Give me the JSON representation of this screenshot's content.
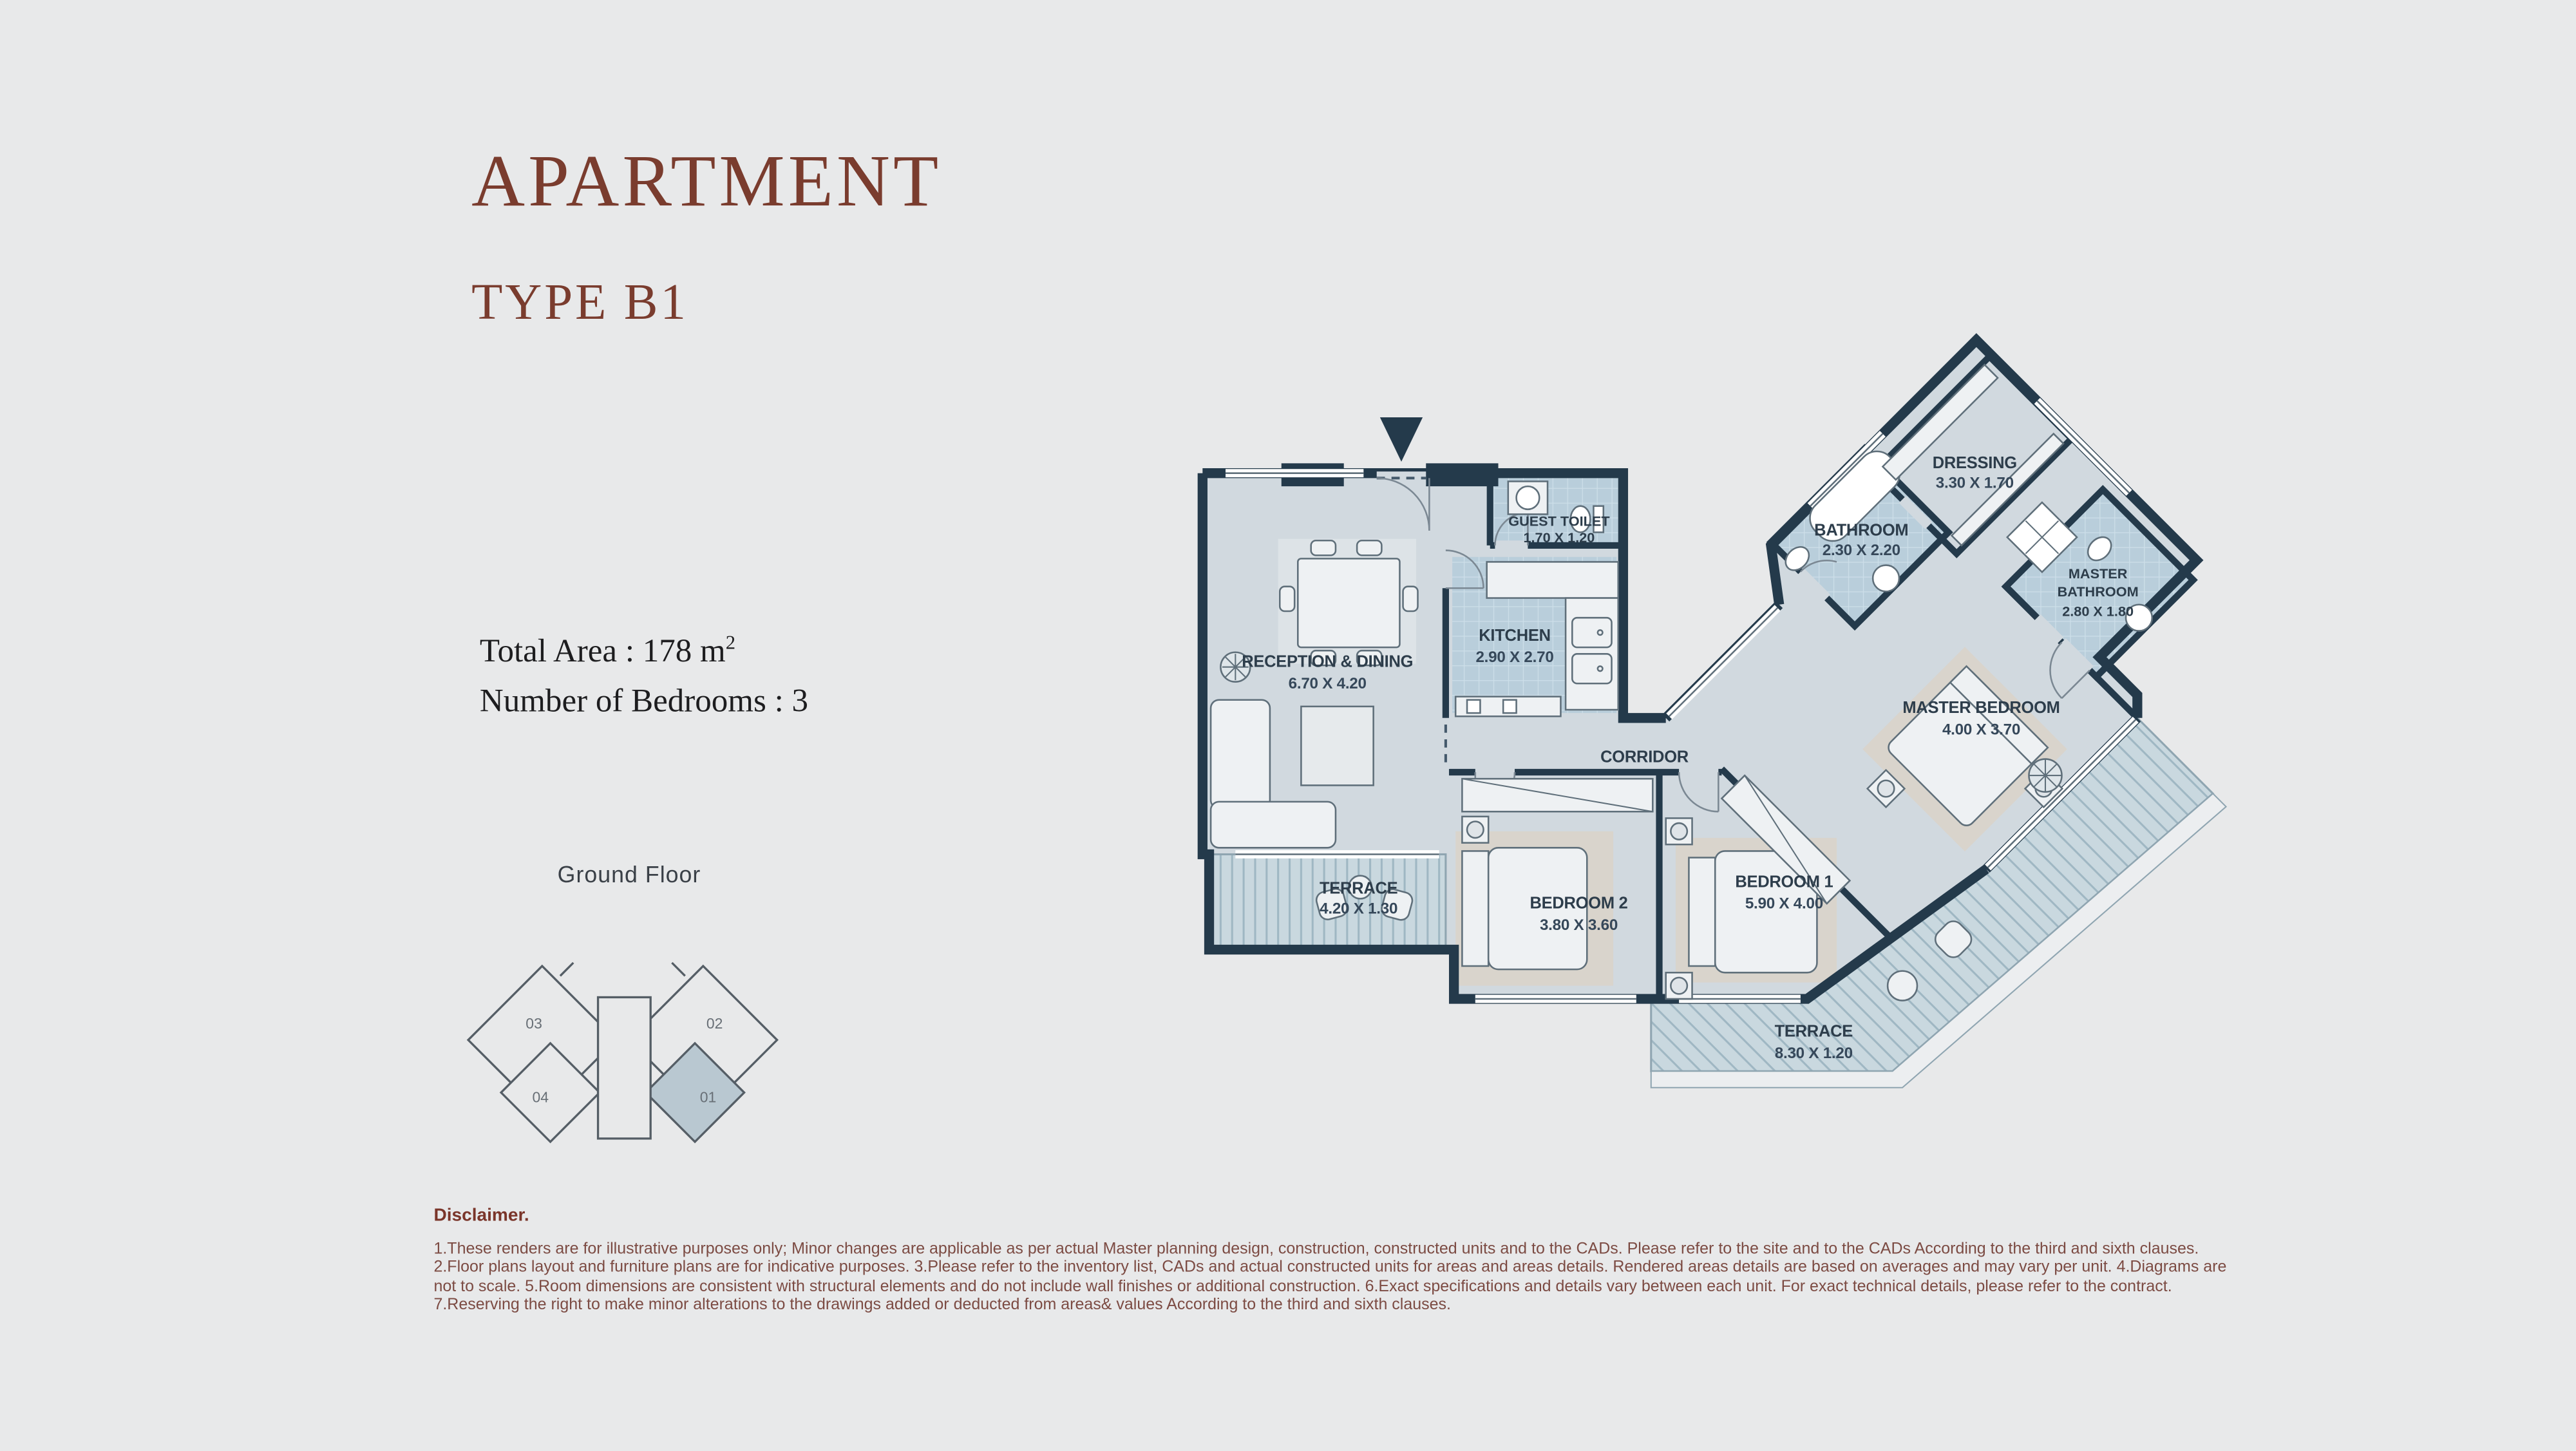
{
  "page": {
    "background": "#e8e9ea"
  },
  "header": {
    "title": "APARTMENT",
    "subtitle": "TYPE B1",
    "accent_color": "#7a3c2e"
  },
  "summary": {
    "total_area_label": "Total Area : ",
    "total_area_value": "178 m",
    "total_area_exponent": "2",
    "bedrooms_label": "Number of Bedrooms : ",
    "bedrooms_value": "3"
  },
  "key_plan": {
    "floor_label": "Ground Floor",
    "highlight_color": "#b9c8d1",
    "units": [
      {
        "label": "03",
        "highlighted": false
      },
      {
        "label": "02",
        "highlighted": false
      },
      {
        "label": "04",
        "highlighted": false
      },
      {
        "label": "01",
        "highlighted": true
      }
    ]
  },
  "floor_plan": {
    "entrance_icon": "entry-direction-arrow",
    "wall_color": "#243a4b",
    "rooms": {
      "reception": {
        "name": "RECEPTION & DINING",
        "dims": "6.70 X 4.20"
      },
      "kitchen": {
        "name": "KITCHEN",
        "dims": "2.90 X 2.70"
      },
      "guest_toilet": {
        "name": "GUEST TOILET",
        "dims": "1.70 X 1.20"
      },
      "corridor": {
        "name": "CORRIDOR"
      },
      "terrace_front": {
        "name": "TERRACE",
        "dims": "4.20 X 1.30"
      },
      "bedroom2": {
        "name": "BEDROOM 2",
        "dims": "3.80 X 3.60"
      },
      "bedroom1": {
        "name": "BEDROOM 1",
        "dims": "5.90 X 4.00"
      },
      "master_bedroom": {
        "name": "MASTER BEDROOM",
        "dims": "4.00 X 3.70"
      },
      "bathroom": {
        "name": "BATHROOM",
        "dims": "2.30 X 2.20"
      },
      "dressing": {
        "name": "DRESSING",
        "dims": "3.30 X 1.70"
      },
      "master_bathroom": {
        "name_line1": "MASTER",
        "name_line2": "BATHROOM",
        "dims": "2.80 X 1.80"
      },
      "terrace_side": {
        "name": "TERRACE",
        "dims": "8.30 X 1.20"
      }
    }
  },
  "disclaimer": {
    "heading": "Disclaimer.",
    "lines": [
      "1.These renders are for illustrative purposes only; Minor changes are applicable as per actual Master planning design, construction, constructed units and to the CADs. Please refer to the site and to the CADs According to the third and sixth clauses.",
      "2.Floor plans layout and furniture plans are for indicative purposes. 3.Please refer to the inventory list, CADs and actual constructed units for areas and areas details. Rendered areas details are based on averages and may vary per unit. 4.Diagrams are",
      "not to scale. 5.Room dimensions are consistent with structural elements and do not include wall finishes or additional construction. 6.Exact specifications and details vary between each unit. For exact technical details, please refer to the contract.",
      "7.Reserving the right to make minor alterations to the drawings  added or deducted from areas& values According to the third and sixth clauses."
    ]
  }
}
